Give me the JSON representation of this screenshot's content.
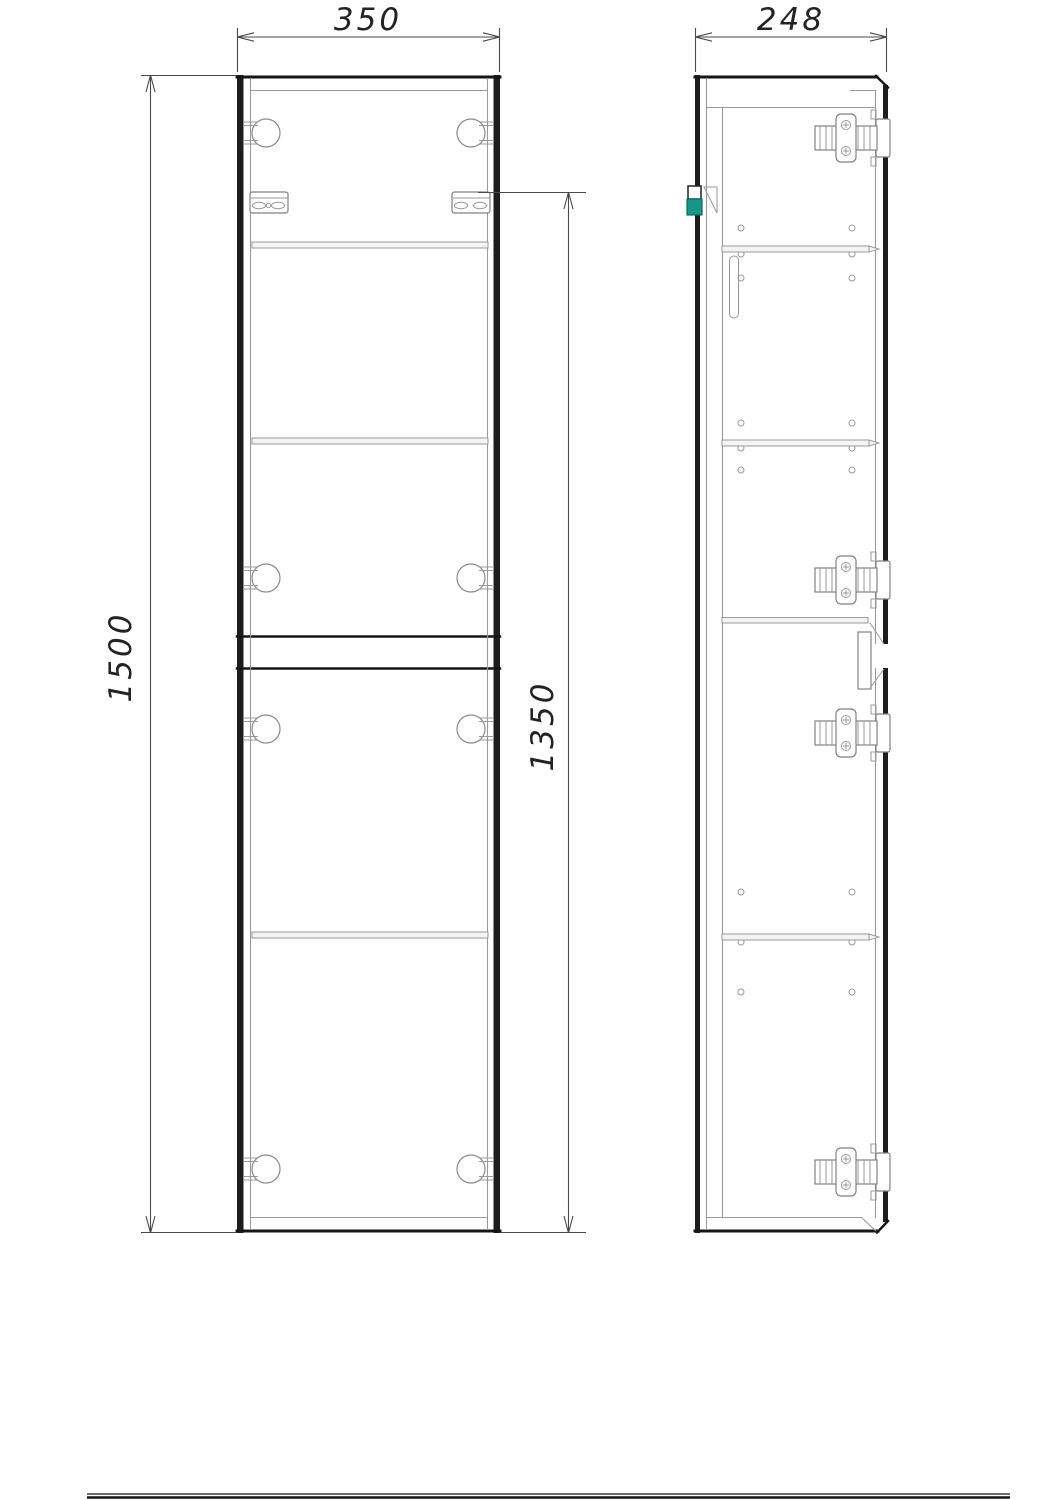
{
  "dimension_labels": {
    "width": "350",
    "depth": "248",
    "height": "1500",
    "rail_to_bottom": "1350"
  },
  "colors": {
    "background": "#ffffff",
    "outline": "#161616",
    "thin_line": "#9a9a9a",
    "dimension_line": "#4a4a4a",
    "accent_teal": "#17948c"
  }
}
